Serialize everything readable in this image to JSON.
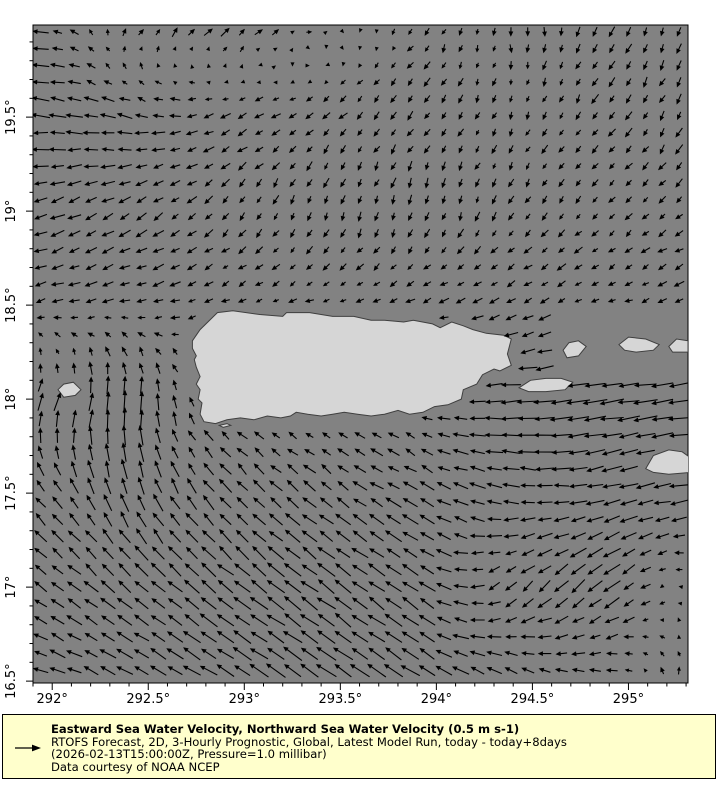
{
  "page": {
    "background": "#ffffff"
  },
  "style": {
    "ocean": "#828282",
    "land": "#d6d6d6",
    "coast": "#3f3f3f",
    "arrow": "#000000",
    "legend_bg": "#ffffcc",
    "frame": {
      "left": 33,
      "top": 25,
      "width": 655,
      "height": 658
    },
    "grid_spacing": 16.8,
    "arrow_scale": 32,
    "jitter": 0.12,
    "land_buffer": 8
  },
  "chart_data": {
    "type": "quiver-map",
    "title": "Eastward Sea Water Velocity, Northward Sea Water Velocity (0.5 m s-1)",
    "region": "Puerto Rico and Virgin Islands",
    "projection": {
      "lon_range": [
        291.9,
        295.31
      ],
      "lat_range": [
        16.49,
        19.99
      ]
    },
    "x_axis": {
      "minor_step": 0.1,
      "major_ticks": [
        {
          "value": 292,
          "label": "292°"
        },
        {
          "value": 292.5,
          "label": "292.5°"
        },
        {
          "value": 293,
          "label": "293°"
        },
        {
          "value": 293.5,
          "label": "293.5°"
        },
        {
          "value": 294,
          "label": "294°"
        },
        {
          "value": 294.5,
          "label": "294.5°"
        },
        {
          "value": 295,
          "label": "295°"
        }
      ]
    },
    "y_axis": {
      "minor_step": 0.1,
      "major_ticks": [
        {
          "value": 16.5,
          "label": "16.5°"
        },
        {
          "value": 17,
          "label": "17°"
        },
        {
          "value": 17.5,
          "label": "17.5°"
        },
        {
          "value": 18,
          "label": "18°"
        },
        {
          "value": 18.5,
          "label": "18.5°"
        },
        {
          "value": 19,
          "label": "19°"
        },
        {
          "value": 19.5,
          "label": "19.5°"
        }
      ]
    },
    "reference_vector": {
      "label": "0.5 m s-1"
    },
    "flow_field": {
      "lons": [
        291.9,
        292.4,
        292.9,
        293.4,
        293.9,
        294.4,
        294.9,
        295.4
      ],
      "lats": [
        16.5,
        17.0,
        17.5,
        18.0,
        18.5,
        19.0,
        19.5,
        20.0
      ],
      "u": [
        [
          -0.45,
          -0.5,
          -0.55,
          -0.6,
          -0.55,
          -0.45,
          -0.3,
          0.1
        ],
        [
          -0.4,
          -0.45,
          -0.5,
          -0.55,
          -0.5,
          -0.35,
          -0.5,
          0.1
        ],
        [
          -0.35,
          -0.2,
          -0.35,
          -0.4,
          -0.45,
          -0.5,
          -0.55,
          -0.6
        ],
        [
          0.2,
          0.1,
          -0.25,
          -0.25,
          -0.25,
          -0.7,
          -0.75,
          -0.7
        ],
        [
          -0.35,
          -0.35,
          -0.25,
          -0.25,
          -0.3,
          -0.3,
          -0.25,
          -0.3
        ],
        [
          -0.45,
          -0.35,
          -0.2,
          -0.1,
          -0.05,
          -0.15,
          -0.2,
          -0.25
        ],
        [
          -0.55,
          -0.45,
          -0.35,
          -0.25,
          -0.2,
          -0.1,
          -0.2,
          -0.15
        ],
        [
          -0.5,
          0.2,
          0.3,
          0.15,
          -0.15,
          0.05,
          -0.15,
          -0.1
        ]
      ],
      "v": [
        [
          0.15,
          0.25,
          0.35,
          0.4,
          0.35,
          0.25,
          0.1,
          0.3
        ],
        [
          0.3,
          0.35,
          0.4,
          0.4,
          0.35,
          -0.35,
          -0.4,
          0.2
        ],
        [
          0.35,
          0.55,
          0.4,
          0.3,
          0.25,
          0.1,
          -0.15,
          -0.1
        ],
        [
          0.5,
          0.7,
          0.1,
          0.1,
          0.1,
          -0.05,
          -0.1,
          -0.1
        ],
        [
          -0.1,
          -0.1,
          -0.1,
          -0.1,
          -0.1,
          -0.15,
          -0.1,
          -0.1
        ],
        [
          -0.15,
          -0.2,
          -0.25,
          -0.3,
          -0.3,
          -0.25,
          -0.2,
          -0.2
        ],
        [
          0.05,
          0.1,
          -0.15,
          -0.2,
          -0.25,
          -0.2,
          -0.25,
          -0.3
        ],
        [
          0.05,
          0.25,
          0.3,
          0.05,
          -0.2,
          -0.25,
          -0.3,
          -0.35
        ]
      ]
    },
    "mask_zones": [
      {
        "lon": [
          294.6,
          295.32
        ],
        "lat": [
          18.13,
          18.44
        ]
      }
    ],
    "islands": {
      "puerto-rico": [
        [
          292.73,
          18.31
        ],
        [
          292.77,
          18.37
        ],
        [
          292.86,
          18.46
        ],
        [
          292.94,
          18.47
        ],
        [
          293.08,
          18.45
        ],
        [
          293.2,
          18.44
        ],
        [
          293.22,
          18.46
        ],
        [
          293.34,
          18.46
        ],
        [
          293.46,
          18.44
        ],
        [
          293.57,
          18.44
        ],
        [
          293.66,
          18.42
        ],
        [
          293.73,
          18.42
        ],
        [
          293.83,
          18.41
        ],
        [
          293.88,
          18.42
        ],
        [
          293.98,
          18.4
        ],
        [
          294.02,
          18.38
        ],
        [
          294.08,
          18.41
        ],
        [
          294.14,
          18.39
        ],
        [
          294.19,
          18.37
        ],
        [
          294.26,
          18.35
        ],
        [
          294.35,
          18.34
        ],
        [
          294.39,
          18.32
        ],
        [
          294.37,
          18.24
        ],
        [
          294.39,
          18.18
        ],
        [
          294.33,
          18.15
        ],
        [
          294.3,
          18.16
        ],
        [
          294.24,
          18.13
        ],
        [
          294.21,
          18.08
        ],
        [
          294.14,
          18.05
        ],
        [
          294.13,
          18.0
        ],
        [
          294.06,
          17.97
        ],
        [
          293.99,
          17.96
        ],
        [
          293.93,
          17.93
        ],
        [
          293.86,
          17.92
        ],
        [
          293.8,
          17.94
        ],
        [
          293.73,
          17.92
        ],
        [
          293.66,
          17.91
        ],
        [
          293.59,
          17.92
        ],
        [
          293.52,
          17.93
        ],
        [
          293.46,
          17.92
        ],
        [
          293.4,
          17.91
        ],
        [
          293.33,
          17.92
        ],
        [
          293.27,
          17.93
        ],
        [
          293.24,
          17.91
        ],
        [
          293.19,
          17.9
        ],
        [
          293.12,
          17.91
        ],
        [
          293.05,
          17.89
        ],
        [
          292.98,
          17.9
        ],
        [
          292.91,
          17.89
        ],
        [
          292.85,
          17.87
        ],
        [
          292.79,
          17.88
        ],
        [
          292.77,
          17.92
        ],
        [
          292.78,
          17.98
        ],
        [
          292.76,
          18.0
        ],
        [
          292.77,
          18.05
        ],
        [
          292.75,
          18.08
        ],
        [
          292.77,
          18.12
        ],
        [
          292.75,
          18.17
        ],
        [
          292.74,
          18.21
        ],
        [
          292.75,
          18.23
        ],
        [
          292.73,
          18.27
        ]
      ],
      "vieques": [
        [
          294.43,
          18.06
        ],
        [
          294.49,
          18.1
        ],
        [
          294.57,
          18.11
        ],
        [
          294.65,
          18.11
        ],
        [
          294.71,
          18.09
        ],
        [
          294.67,
          18.05
        ],
        [
          294.57,
          18.04
        ],
        [
          294.48,
          18.04
        ]
      ],
      "culebra": [
        [
          294.66,
          18.26
        ],
        [
          294.69,
          18.3
        ],
        [
          294.74,
          18.31
        ],
        [
          294.78,
          18.28
        ],
        [
          294.74,
          18.23
        ],
        [
          294.68,
          18.22
        ]
      ],
      "st-thomas": [
        [
          294.95,
          18.29
        ],
        [
          295.0,
          18.33
        ],
        [
          295.09,
          18.32
        ],
        [
          295.16,
          18.29
        ],
        [
          295.13,
          18.26
        ],
        [
          295.04,
          18.25
        ],
        [
          294.98,
          18.26
        ]
      ],
      "st-john-tortola": [
        [
          295.21,
          18.28
        ],
        [
          295.25,
          18.32
        ],
        [
          295.31,
          18.31
        ],
        [
          295.31,
          18.25
        ],
        [
          295.23,
          18.25
        ]
      ],
      "st-croix": [
        [
          295.09,
          17.63
        ],
        [
          295.13,
          17.7
        ],
        [
          295.21,
          17.73
        ],
        [
          295.28,
          17.72
        ],
        [
          295.32,
          17.69
        ],
        [
          295.32,
          17.61
        ],
        [
          295.21,
          17.6
        ],
        [
          295.13,
          17.61
        ]
      ],
      "mona": [
        [
          292.03,
          18.05
        ],
        [
          292.06,
          18.08
        ],
        [
          292.11,
          18.09
        ],
        [
          292.15,
          18.05
        ],
        [
          292.12,
          18.02
        ],
        [
          292.06,
          18.01
        ]
      ],
      "caja-de-muertos": [
        [
          292.87,
          17.86
        ],
        [
          292.91,
          17.87
        ],
        [
          292.93,
          17.86
        ],
        [
          292.89,
          17.85
        ]
      ]
    }
  },
  "legend": {
    "title": "Eastward Sea Water Velocity, Northward Sea Water Velocity (0.5 m s-1)",
    "subtitle": "RTOFS Forecast, 2D, 3-Hourly Prognostic, Global, Latest Model Run, today - today+8days",
    "timestamp_line": "(2026-02-13T15:00:00Z, Pressure=1.0 millibar)",
    "credit": "Data courtesy of NOAA NCEP"
  }
}
